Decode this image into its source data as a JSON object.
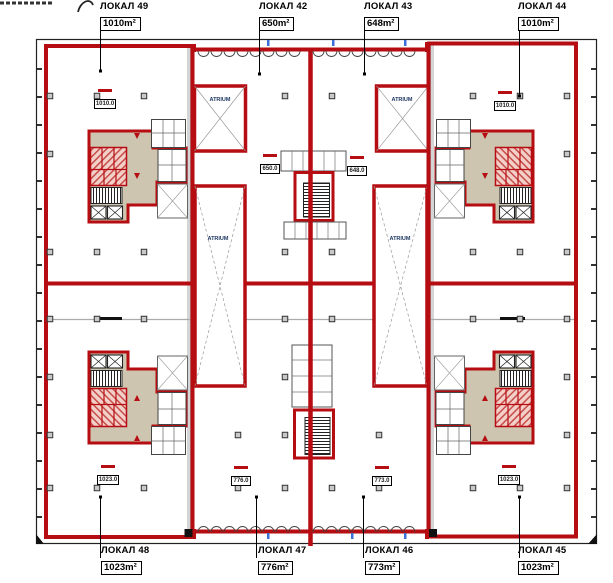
{
  "labels": {
    "atrium": "ATRIUM"
  },
  "units": [
    {
      "name": "ЛОКАЛ 49",
      "area": "1010m²",
      "stamp": "1010.0"
    },
    {
      "name": "ЛОКАЛ 42",
      "area": "650m²",
      "stamp": "650.0"
    },
    {
      "name": "ЛОКАЛ 43",
      "area": "648m²",
      "stamp": "648.0"
    },
    {
      "name": "ЛОКАЛ 44",
      "area": "1010m²",
      "stamp": "1010.0"
    },
    {
      "name": "ЛОКАЛ 48",
      "area": "1023m²",
      "stamp": "1023.0"
    },
    {
      "name": "ЛОКАЛ 47",
      "area": "776m²",
      "stamp": "776.0"
    },
    {
      "name": "ЛОКАЛ 46",
      "area": "773m²",
      "stamp": "773.0"
    },
    {
      "name": "ЛОКАЛ 45",
      "area": "1023m²",
      "stamp": "1023.0"
    }
  ],
  "colors": {
    "wall_red": "#b60d12",
    "core_beige": "#cdc5af",
    "atrium_text": "#1f3864",
    "tick_blue": "#3a6fd8"
  }
}
